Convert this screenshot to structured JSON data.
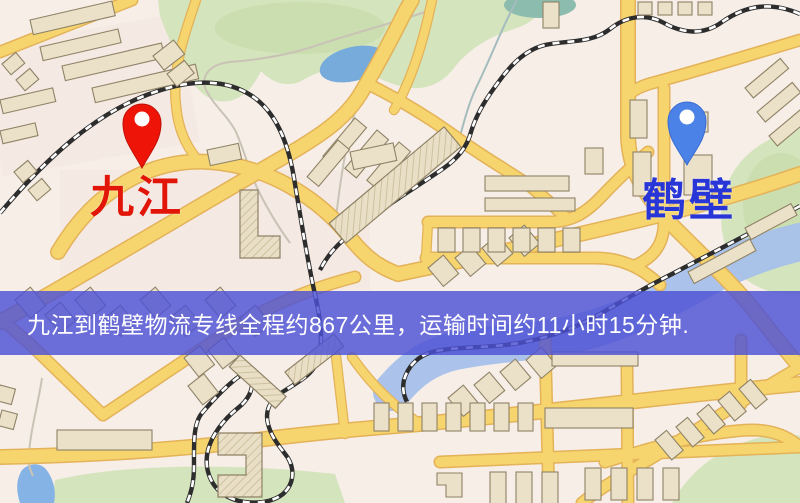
{
  "banner": {
    "text": "九江到鹤壁物流专线全程约867公里，运输时间约11小时15分钟.",
    "background": "#4c51d6",
    "text_color": "#ffffff"
  },
  "markers": {
    "origin": {
      "label": "九江",
      "pin_color": "#ee1408",
      "label_color": "#e11508"
    },
    "destination": {
      "label": "鹤壁",
      "pin_color": "#4b82e8",
      "label_color": "#2836d8"
    }
  },
  "route": {
    "origin_city": "九江",
    "destination_city": "鹤壁",
    "distance_text": "约867公里",
    "duration_text": "约11小时15分钟"
  },
  "map_palette": {
    "map_bg": "#f6eee7",
    "road_fill": "#f6d56f",
    "road_casing": "#e4b258",
    "building_fill": "#ebe1c9",
    "building_stroke": "#8f8266",
    "park_green": "#d4e4bc",
    "park_green_dark": "#c8dcab",
    "water_blue": "#76abdc",
    "river_blue": "#a6c0ea",
    "railway_dark": "#2d2d2d",
    "railway_light": "#ffffff",
    "minor_road": "#c9c3b6",
    "stream": "#a5bcbe",
    "pink_zone": "#f2e3de"
  }
}
